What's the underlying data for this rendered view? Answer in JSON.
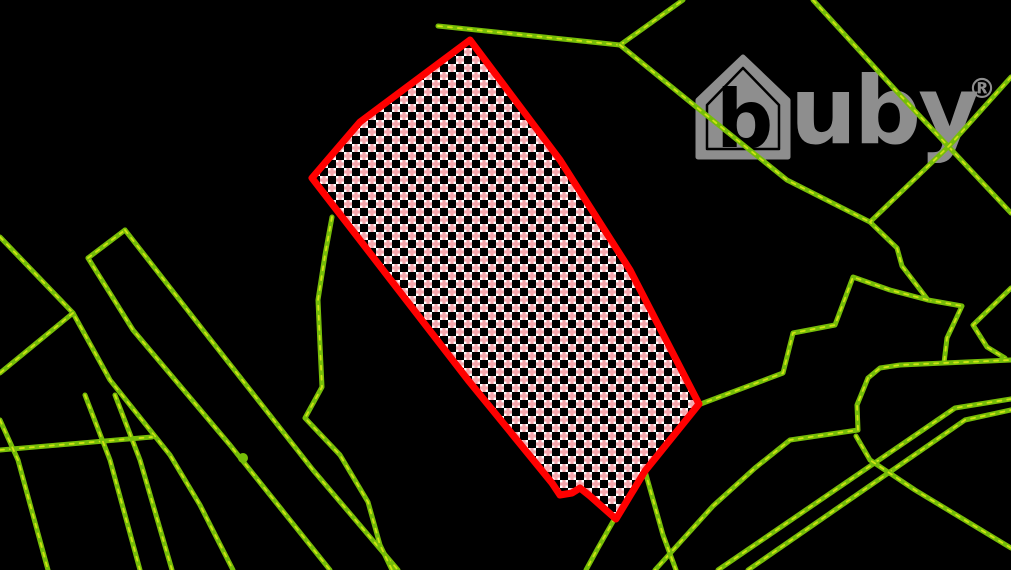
{
  "map": {
    "background": "#000000",
    "viewport": {
      "width": 1011,
      "height": 570
    },
    "watermark": {
      "letter_b": "b",
      "text_uby": "uby",
      "registered": "®",
      "color": "#8e8e8e",
      "house_outer": "743,57 788,100 788,157 698,157 698,100",
      "house_inner": "743,68 779,105 779,149 707,149 707,105",
      "positions": {
        "b_x": 716,
        "b_y": 147,
        "b_size": 80,
        "uby_x": 790,
        "uby_y": 143,
        "uby_size": 94,
        "reg_x": 968,
        "reg_y": 98,
        "reg_size": 28
      }
    },
    "parcel": {
      "stroke": "#ff0000",
      "stroke_width": 7,
      "checker": {
        "white": "#ffffff",
        "pink": "#f3a7ad",
        "cell": 8
      },
      "points": [
        [
          470,
          40
        ],
        [
          560,
          160
        ],
        [
          630,
          270
        ],
        [
          699,
          404
        ],
        [
          645,
          471
        ],
        [
          616,
          519
        ],
        [
          590,
          496
        ],
        [
          580,
          488
        ],
        [
          572,
          493
        ],
        [
          560,
          495
        ],
        [
          552,
          483
        ],
        [
          468,
          380
        ],
        [
          312,
          178
        ],
        [
          360,
          122
        ]
      ]
    },
    "boundaries": {
      "color": "#76bd08",
      "highlight": "#d9e814",
      "width": 5,
      "lines": [
        [
          [
            0,
            237
          ],
          [
            73,
            313
          ],
          [
            110,
            380
          ],
          [
            170,
            455
          ],
          [
            200,
            505
          ],
          [
            233,
            570
          ]
        ],
        [
          [
            73,
            313
          ],
          [
            0,
            373
          ]
        ],
        [
          [
            88,
            258
          ],
          [
            133,
            330
          ],
          [
            230,
            445
          ],
          [
            290,
            520
          ],
          [
            330,
            570
          ]
        ],
        [
          [
            88,
            258
          ],
          [
            125,
            230
          ]
        ],
        [
          [
            125,
            230
          ],
          [
            203,
            330
          ],
          [
            313,
            470
          ],
          [
            398,
            570
          ]
        ],
        [
          [
            0,
            450
          ],
          [
            152,
            437
          ]
        ],
        [
          [
            0,
            420
          ],
          [
            18,
            460
          ],
          [
            48,
            570
          ]
        ],
        [
          [
            85,
            395
          ],
          [
            110,
            460
          ],
          [
            140,
            570
          ]
        ],
        [
          [
            115,
            395
          ],
          [
            140,
            460
          ],
          [
            172,
            570
          ]
        ],
        [
          [
            332,
            217
          ],
          [
            325,
            255
          ],
          [
            318,
            300
          ],
          [
            320,
            345
          ],
          [
            322,
            387
          ],
          [
            305,
            418
          ],
          [
            340,
            455
          ],
          [
            368,
            502
          ],
          [
            380,
            545
          ],
          [
            392,
            570
          ]
        ],
        [
          [
            438,
            26
          ],
          [
            620,
            45
          ]
        ],
        [
          [
            620,
            45
          ],
          [
            683,
            0
          ]
        ],
        [
          [
            620,
            45
          ],
          [
            700,
            110
          ],
          [
            787,
            180
          ],
          [
            870,
            222
          ]
        ],
        [
          [
            813,
            0
          ],
          [
            900,
            95
          ],
          [
            1011,
            213
          ]
        ],
        [
          [
            1011,
            77
          ],
          [
            950,
            145
          ],
          [
            870,
            222
          ],
          [
            897,
            248
          ],
          [
            902,
            266
          ],
          [
            928,
            300
          ],
          [
            962,
            306
          ],
          [
            947,
            338
          ],
          [
            944,
            363
          ]
        ],
        [
          [
            1011,
            288
          ],
          [
            973,
            325
          ],
          [
            987,
            347
          ],
          [
            1005,
            358
          ]
        ],
        [
          [
            868,
            378
          ],
          [
            880,
            368
          ],
          [
            900,
            365
          ],
          [
            1011,
            360
          ]
        ],
        [
          [
            698,
            405
          ],
          [
            783,
            373
          ],
          [
            793,
            333
          ],
          [
            835,
            325
          ],
          [
            853,
            277
          ],
          [
            890,
            290
          ],
          [
            928,
            300
          ]
        ],
        [
          [
            868,
            378
          ],
          [
            857,
            405
          ],
          [
            858,
            430
          ],
          [
            790,
            440
          ],
          [
            755,
            468
          ],
          [
            713,
            506
          ],
          [
            655,
            570
          ]
        ],
        [
          [
            615,
            518
          ],
          [
            598,
            548
          ],
          [
            586,
            570
          ]
        ],
        [
          [
            645,
            471
          ],
          [
            663,
            535
          ],
          [
            676,
            570
          ]
        ],
        [
          [
            718,
            570
          ],
          [
            955,
            408
          ],
          [
            1011,
            399
          ]
        ],
        [
          [
            748,
            570
          ],
          [
            965,
            420
          ],
          [
            1011,
            410
          ]
        ],
        [
          [
            856,
            436
          ],
          [
            870,
            460
          ],
          [
            915,
            490
          ],
          [
            1011,
            548
          ]
        ]
      ]
    },
    "marker_dot": {
      "x": 243,
      "y": 458,
      "r": 5
    }
  }
}
